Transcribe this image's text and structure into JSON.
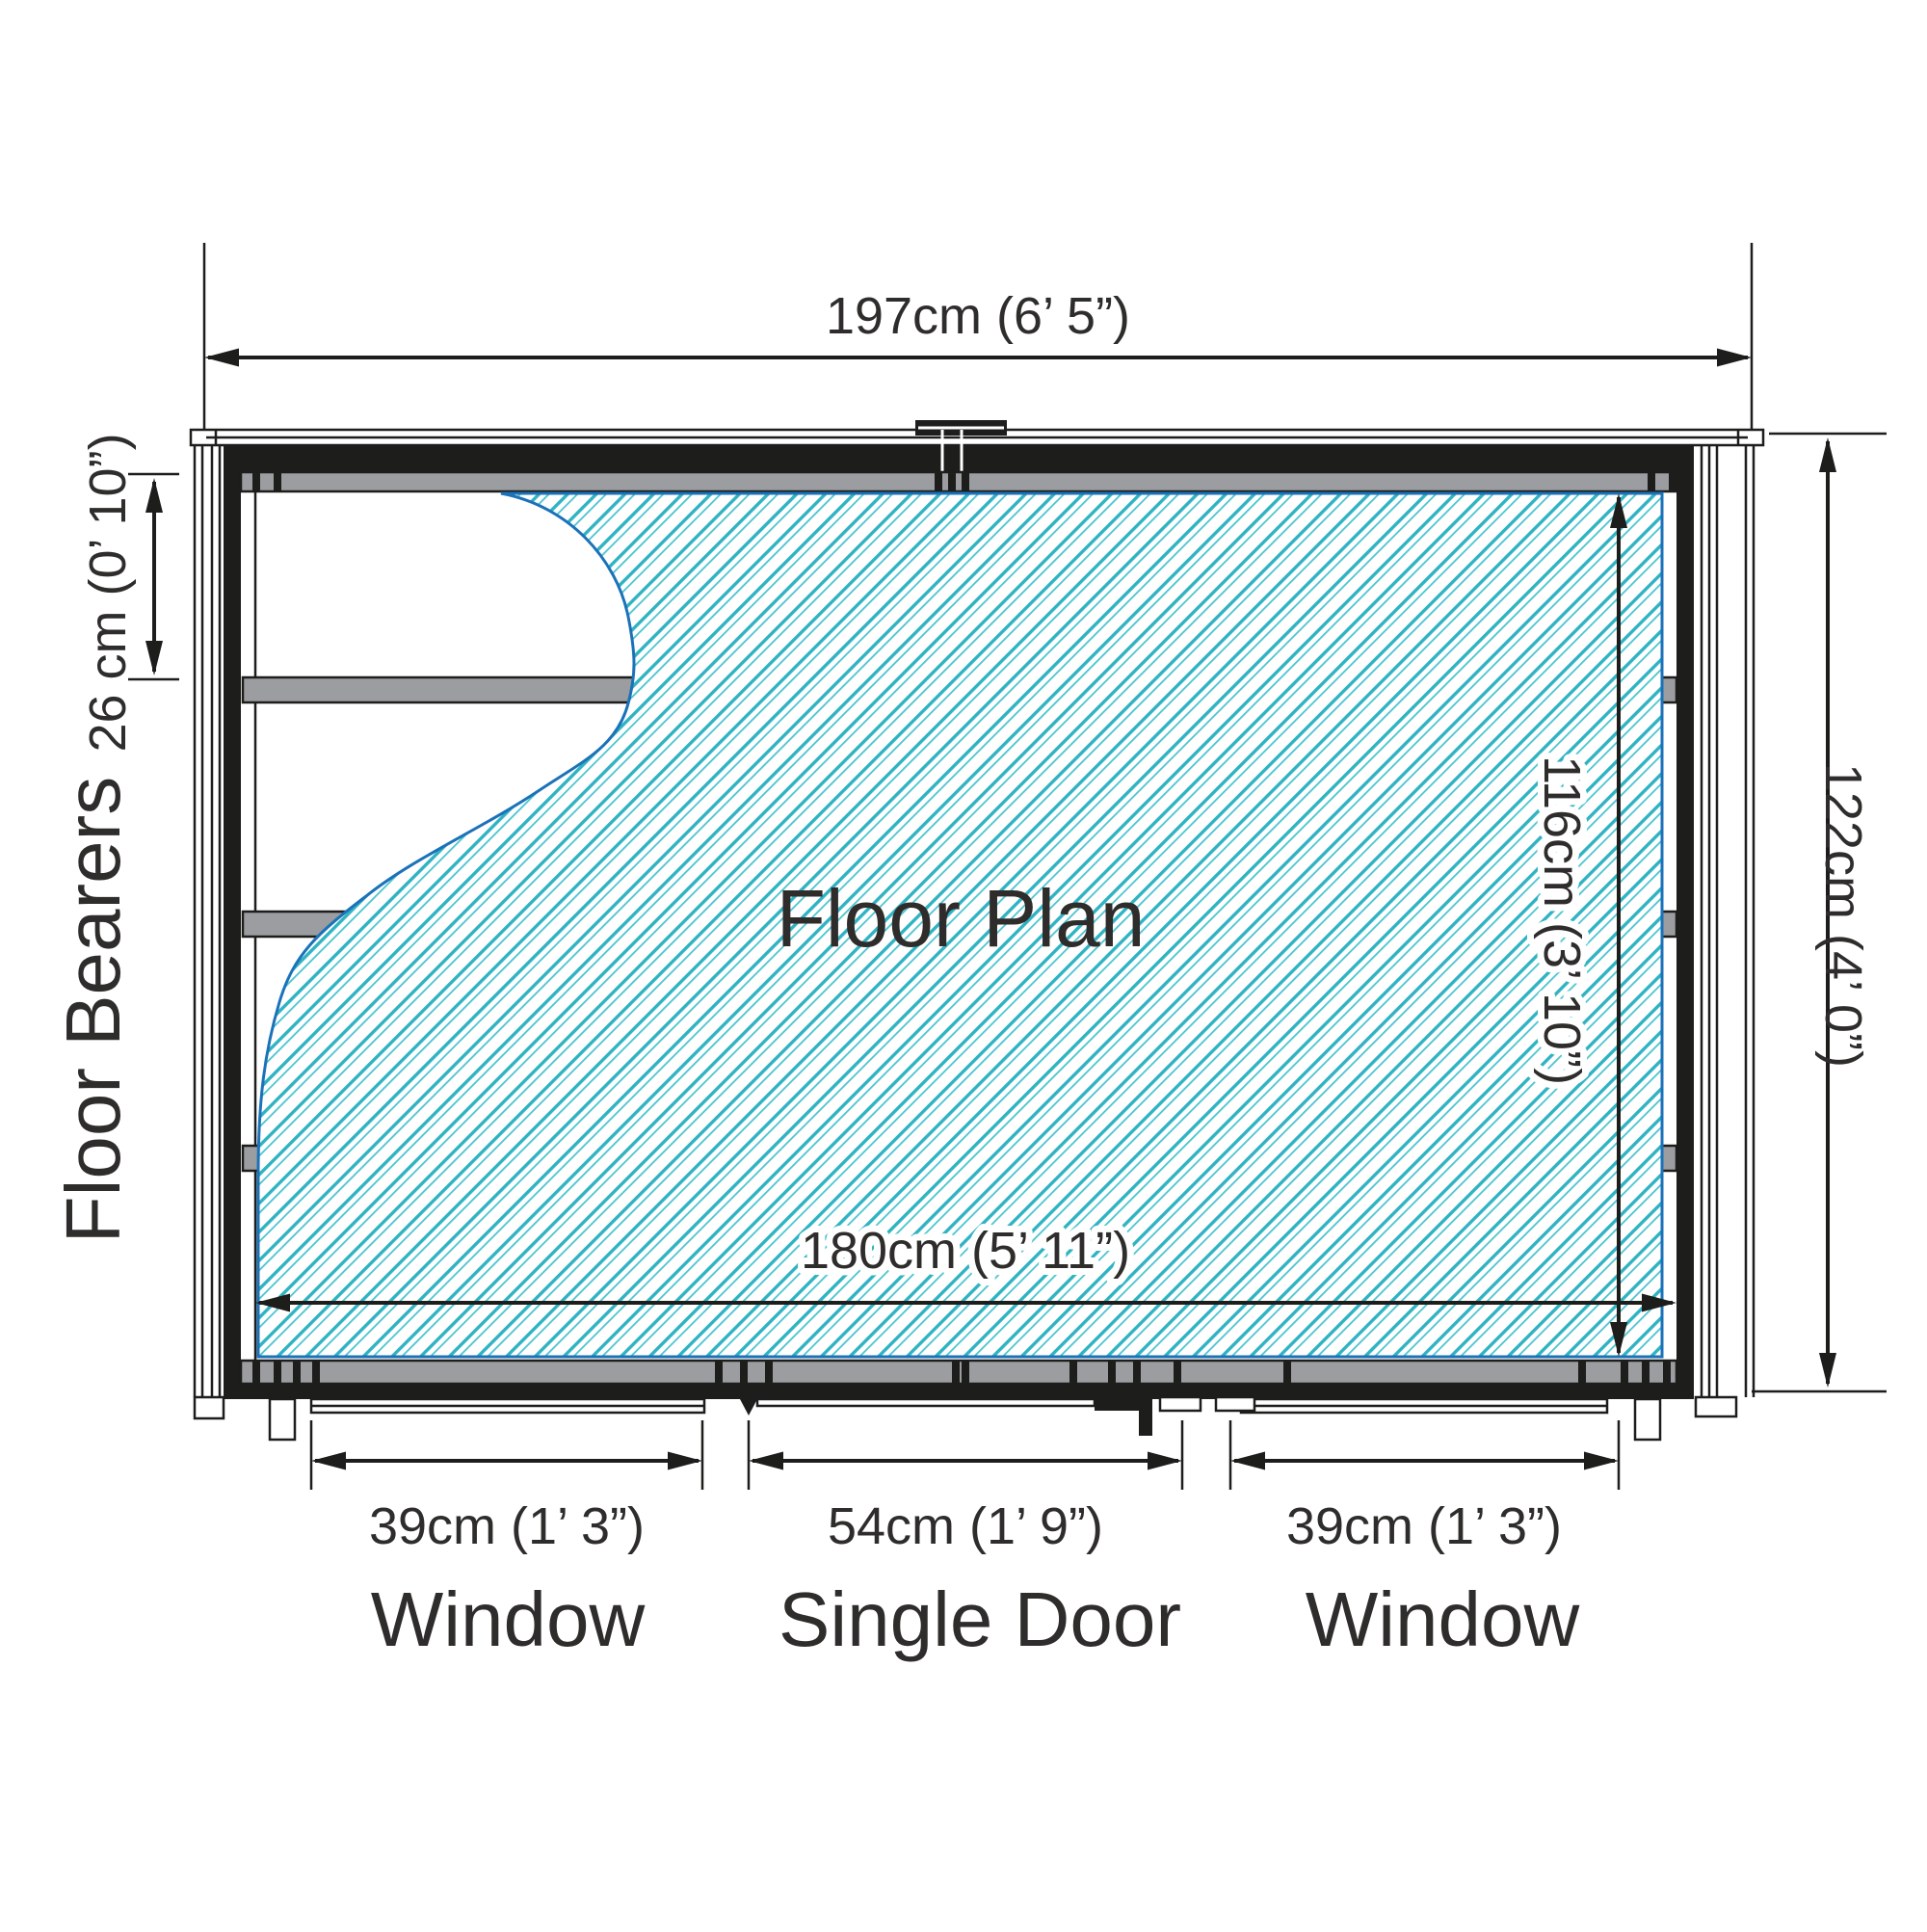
{
  "title": "Floor Plan",
  "dimensions": {
    "overall_width": "197cm (6’ 5”)",
    "overall_depth": "122cm (4’ 0”)",
    "internal_width": "180cm (5’ 11”)",
    "internal_depth": "116cm (3’ 10”)",
    "bearer_spacing": "26 cm (0’ 10”)"
  },
  "side_labels": {
    "floor_bearers": "Floor Bearers"
  },
  "openings": {
    "window_left": {
      "size": "39cm (1’ 3”)",
      "label": "Window"
    },
    "single_door": {
      "size": "54cm (1’ 9”)",
      "label": "Single Door"
    },
    "window_right": {
      "size": "39cm (1’ 3”)",
      "label": "Window"
    }
  },
  "colors": {
    "hatch_teal": "#2fb3c3",
    "hatch_teal_light": "#4cc4cf",
    "boundary_blue": "#1b72b8",
    "bearer_gray": "#9b9da0",
    "line_black": "#1d1d1b",
    "text_color": "#2e2d2c"
  }
}
